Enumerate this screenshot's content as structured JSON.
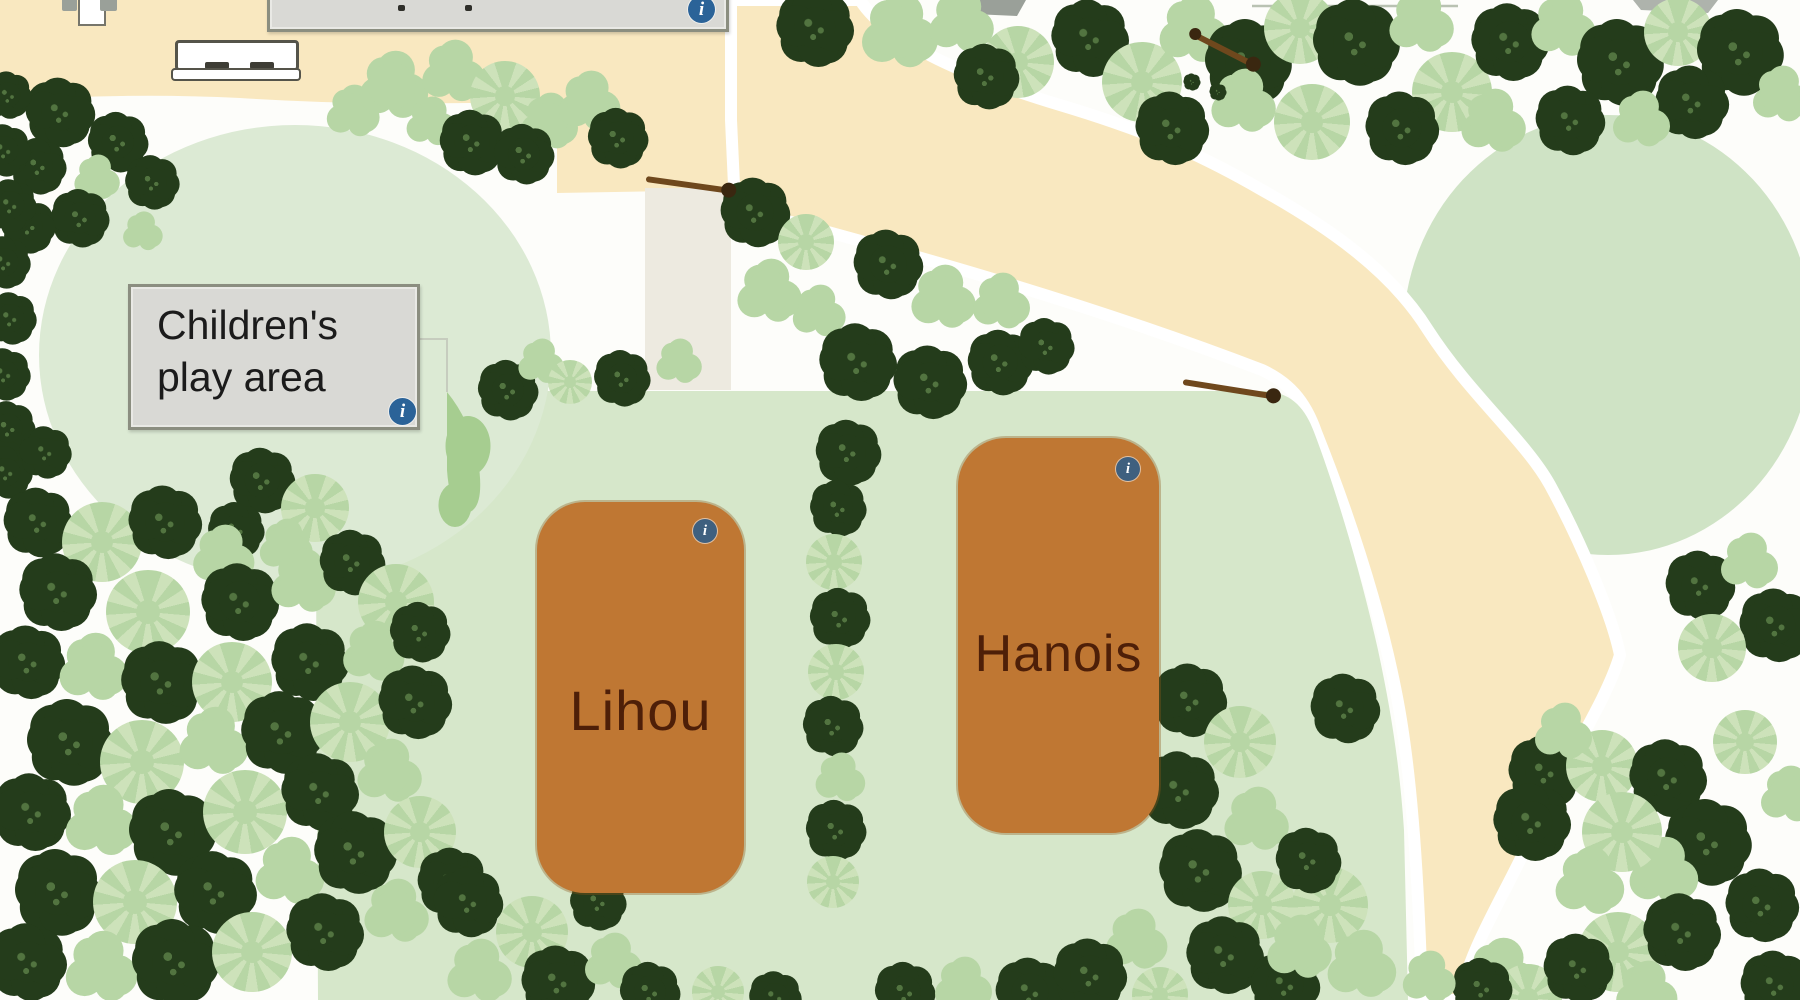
{
  "play_area": {
    "line1": "Children's",
    "line2": "play area"
  },
  "pitches": [
    {
      "name": "Lihou"
    },
    {
      "name": "Hanois"
    }
  ],
  "ui": {
    "info_glyph": "i"
  },
  "theme": {
    "bg": "#fdfdfa",
    "path": "#f9e8c0",
    "pathpale": "#edeae0",
    "playground": "#dcead4",
    "field": "#d6e7ca",
    "circlegreen": "#cfe3c5",
    "td": "#243c1b",
    "tds": "#527440",
    "tl": "#b7d6a5",
    "tl2": "#cde2ba",
    "tm": "#a6cd90",
    "pitch": "#bf7733",
    "pitchtext": "#4e1f08",
    "labelbg": "#d9d9d5",
    "labelborder": "#8b8e80",
    "labeltext": "#1b1b1b",
    "info": "#2b6398",
    "info2": "#3f607f",
    "fence": "#6f481d",
    "bench": "#55544a",
    "roof": "#9aa099"
  },
  "trees": [
    [
      60,
      112,
      32,
      "d"
    ],
    [
      118,
      142,
      28,
      "d"
    ],
    [
      38,
      166,
      26,
      "d"
    ],
    [
      96,
      178,
      24,
      "b"
    ],
    [
      152,
      182,
      25,
      "d"
    ],
    [
      80,
      218,
      27,
      "d"
    ],
    [
      28,
      226,
      25,
      "d"
    ],
    [
      142,
      232,
      21,
      "b"
    ],
    [
      8,
      95,
      22,
      "d"
    ],
    [
      4,
      150,
      24,
      "d"
    ],
    [
      10,
      205,
      24,
      "d"
    ],
    [
      4,
      262,
      24,
      "d"
    ],
    [
      10,
      318,
      24,
      "d"
    ],
    [
      4,
      374,
      24,
      "d"
    ],
    [
      8,
      428,
      25,
      "d"
    ],
    [
      6,
      472,
      24,
      "d"
    ],
    [
      352,
      112,
      28,
      "b"
    ],
    [
      392,
      86,
      36,
      "b"
    ],
    [
      452,
      72,
      33,
      "b"
    ],
    [
      430,
      122,
      26,
      "b"
    ],
    [
      505,
      96,
      35,
      "p"
    ],
    [
      548,
      122,
      30,
      "b"
    ],
    [
      472,
      142,
      30,
      "d"
    ],
    [
      524,
      154,
      28,
      "d"
    ],
    [
      588,
      102,
      32,
      "b"
    ],
    [
      618,
      138,
      28,
      "d"
    ],
    [
      262,
      480,
      30,
      "d"
    ],
    [
      315,
      508,
      34,
      "p"
    ],
    [
      285,
      546,
      28,
      "b"
    ],
    [
      236,
      530,
      26,
      "d"
    ],
    [
      45,
      452,
      24,
      "d"
    ],
    [
      508,
      390,
      28,
      "d"
    ],
    [
      540,
      362,
      24,
      "b"
    ],
    [
      570,
      382,
      22,
      "p"
    ],
    [
      622,
      378,
      26,
      "d"
    ],
    [
      678,
      362,
      24,
      "b"
    ],
    [
      815,
      28,
      36,
      "d"
    ],
    [
      898,
      32,
      40,
      "b"
    ],
    [
      960,
      22,
      34,
      "b"
    ],
    [
      1018,
      62,
      36,
      "p"
    ],
    [
      986,
      76,
      30,
      "d"
    ],
    [
      755,
      212,
      32,
      "d"
    ],
    [
      806,
      242,
      28,
      "p"
    ],
    [
      768,
      292,
      34,
      "b"
    ],
    [
      818,
      312,
      28,
      "b"
    ],
    [
      888,
      264,
      32,
      "d"
    ],
    [
      942,
      298,
      34,
      "b"
    ],
    [
      1000,
      302,
      30,
      "b"
    ],
    [
      858,
      362,
      36,
      "d"
    ],
    [
      930,
      382,
      34,
      "d"
    ],
    [
      1000,
      362,
      30,
      "d"
    ],
    [
      1046,
      346,
      26,
      "d"
    ],
    [
      1090,
      38,
      36,
      "d"
    ],
    [
      1142,
      82,
      40,
      "p"
    ],
    [
      1192,
      30,
      36,
      "b"
    ],
    [
      1248,
      62,
      40,
      "d"
    ],
    [
      1300,
      28,
      36,
      "p"
    ],
    [
      1356,
      42,
      40,
      "d"
    ],
    [
      1420,
      22,
      34,
      "b"
    ],
    [
      1452,
      92,
      40,
      "p"
    ],
    [
      1510,
      42,
      36,
      "d"
    ],
    [
      1562,
      26,
      34,
      "b"
    ],
    [
      1620,
      62,
      40,
      "d"
    ],
    [
      1678,
      32,
      34,
      "p"
    ],
    [
      1740,
      52,
      40,
      "d"
    ],
    [
      1780,
      95,
      30,
      "b"
    ],
    [
      1692,
      102,
      34,
      "d"
    ],
    [
      1242,
      102,
      34,
      "b"
    ],
    [
      1172,
      128,
      34,
      "d"
    ],
    [
      1312,
      122,
      38,
      "p"
    ],
    [
      1402,
      128,
      34,
      "d"
    ],
    [
      1492,
      122,
      34,
      "b"
    ],
    [
      1570,
      120,
      32,
      "d"
    ],
    [
      1640,
      120,
      30,
      "b"
    ],
    [
      1192,
      82,
      8,
      "d"
    ],
    [
      1218,
      92,
      8,
      "d"
    ],
    [
      848,
      452,
      30,
      "d"
    ],
    [
      838,
      508,
      26,
      "d"
    ],
    [
      834,
      562,
      28,
      "p"
    ],
    [
      840,
      618,
      28,
      "d"
    ],
    [
      836,
      672,
      28,
      "p"
    ],
    [
      833,
      726,
      28,
      "d"
    ],
    [
      839,
      778,
      26,
      "b"
    ],
    [
      836,
      830,
      28,
      "d"
    ],
    [
      833,
      882,
      26,
      "p"
    ],
    [
      38,
      522,
      32,
      "d"
    ],
    [
      102,
      542,
      40,
      "p"
    ],
    [
      165,
      522,
      34,
      "d"
    ],
    [
      222,
      556,
      32,
      "b"
    ],
    [
      58,
      592,
      36,
      "d"
    ],
    [
      148,
      612,
      42,
      "p"
    ],
    [
      240,
      602,
      36,
      "d"
    ],
    [
      302,
      582,
      34,
      "b"
    ],
    [
      352,
      562,
      30,
      "d"
    ],
    [
      396,
      602,
      38,
      "p"
    ],
    [
      28,
      662,
      34,
      "d"
    ],
    [
      92,
      668,
      36,
      "b"
    ],
    [
      162,
      682,
      38,
      "d"
    ],
    [
      232,
      682,
      40,
      "p"
    ],
    [
      310,
      662,
      36,
      "d"
    ],
    [
      372,
      652,
      32,
      "b"
    ],
    [
      420,
      632,
      28,
      "d"
    ],
    [
      70,
      742,
      40,
      "d"
    ],
    [
      142,
      762,
      42,
      "p"
    ],
    [
      212,
      742,
      36,
      "b"
    ],
    [
      282,
      732,
      38,
      "d"
    ],
    [
      350,
      722,
      40,
      "p"
    ],
    [
      415,
      702,
      34,
      "d"
    ],
    [
      32,
      812,
      36,
      "d"
    ],
    [
      100,
      822,
      38,
      "b"
    ],
    [
      172,
      832,
      40,
      "d"
    ],
    [
      245,
      812,
      42,
      "p"
    ],
    [
      320,
      792,
      36,
      "d"
    ],
    [
      388,
      772,
      34,
      "b"
    ],
    [
      58,
      892,
      40,
      "d"
    ],
    [
      135,
      902,
      42,
      "p"
    ],
    [
      215,
      892,
      38,
      "d"
    ],
    [
      288,
      872,
      36,
      "b"
    ],
    [
      355,
      852,
      38,
      "d"
    ],
    [
      420,
      832,
      36,
      "p"
    ],
    [
      28,
      962,
      36,
      "d"
    ],
    [
      100,
      968,
      38,
      "b"
    ],
    [
      175,
      962,
      40,
      "d"
    ],
    [
      252,
      952,
      40,
      "p"
    ],
    [
      325,
      932,
      36,
      "d"
    ],
    [
      395,
      912,
      34,
      "b"
    ],
    [
      452,
      882,
      32,
      "d"
    ],
    [
      468,
      902,
      32,
      "d"
    ],
    [
      532,
      932,
      36,
      "p"
    ],
    [
      478,
      972,
      34,
      "b"
    ],
    [
      558,
      982,
      34,
      "d"
    ],
    [
      612,
      962,
      30,
      "b"
    ],
    [
      650,
      992,
      28,
      "d"
    ],
    [
      598,
      902,
      26,
      "d"
    ],
    [
      718,
      992,
      26,
      "p"
    ],
    [
      775,
      997,
      24,
      "d"
    ],
    [
      905,
      992,
      28,
      "d"
    ],
    [
      962,
      986,
      30,
      "b"
    ],
    [
      1030,
      992,
      32,
      "d"
    ],
    [
      468,
      446,
      30,
      "m"
    ],
    [
      455,
      505,
      22,
      "m"
    ],
    [
      1190,
      700,
      34,
      "d"
    ],
    [
      1240,
      742,
      36,
      "p"
    ],
    [
      1180,
      790,
      36,
      "d"
    ],
    [
      1255,
      820,
      34,
      "b"
    ],
    [
      1200,
      870,
      38,
      "d"
    ],
    [
      1262,
      905,
      34,
      "p"
    ],
    [
      1225,
      955,
      36,
      "d"
    ],
    [
      1285,
      985,
      32,
      "d"
    ],
    [
      1135,
      940,
      32,
      "b"
    ],
    [
      1090,
      975,
      34,
      "d"
    ],
    [
      1160,
      995,
      28,
      "p"
    ],
    [
      1345,
      708,
      32,
      "d"
    ],
    [
      1330,
      905,
      38,
      "p"
    ],
    [
      1298,
      948,
      34,
      "b"
    ],
    [
      1360,
      965,
      36,
      "b"
    ],
    [
      1308,
      860,
      30,
      "d"
    ],
    [
      1500,
      975,
      38,
      "b"
    ],
    [
      1528,
      998,
      34,
      "p"
    ],
    [
      1700,
      585,
      32,
      "d"
    ],
    [
      1748,
      562,
      30,
      "b"
    ],
    [
      1776,
      625,
      34,
      "d"
    ],
    [
      1712,
      648,
      34,
      "p"
    ],
    [
      1545,
      772,
      34,
      "d"
    ],
    [
      1602,
      766,
      36,
      "p"
    ],
    [
      1562,
      732,
      30,
      "b"
    ],
    [
      1668,
      778,
      36,
      "d"
    ],
    [
      1708,
      842,
      40,
      "d"
    ],
    [
      1662,
      872,
      36,
      "b"
    ],
    [
      1622,
      832,
      40,
      "p"
    ],
    [
      1532,
      822,
      36,
      "d"
    ],
    [
      1588,
      882,
      36,
      "b"
    ],
    [
      1618,
      952,
      40,
      "p"
    ],
    [
      1578,
      968,
      32,
      "d"
    ],
    [
      1682,
      932,
      36,
      "d"
    ],
    [
      1645,
      992,
      32,
      "b"
    ],
    [
      1482,
      988,
      28,
      "d"
    ],
    [
      1428,
      978,
      28,
      "b"
    ],
    [
      1762,
      905,
      34,
      "d"
    ],
    [
      1788,
      795,
      30,
      "b"
    ],
    [
      1745,
      742,
      32,
      "p"
    ],
    [
      1775,
      985,
      32,
      "d"
    ]
  ]
}
